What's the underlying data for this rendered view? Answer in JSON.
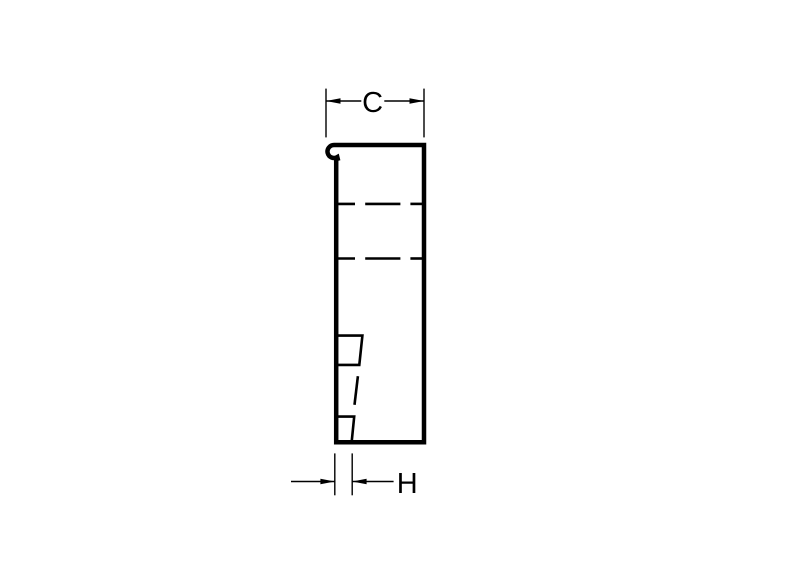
{
  "diagram": {
    "description": "profile-cross-section-drawing",
    "dimension_labels": {
      "c": "C",
      "h": "H"
    },
    "colors": {
      "line": "#000000",
      "background": "#ffffff"
    }
  }
}
